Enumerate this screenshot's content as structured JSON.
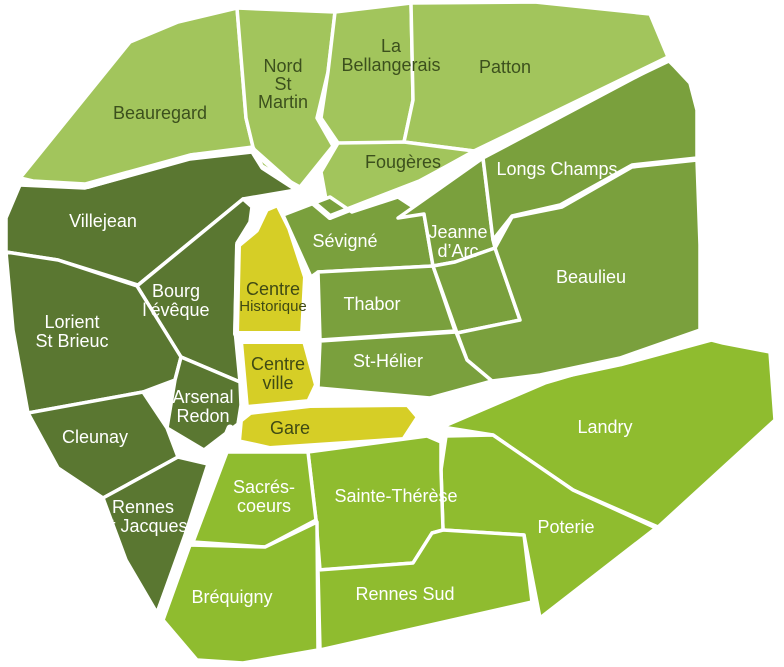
{
  "map": {
    "name": "rennes-districts-map",
    "width": 784,
    "height": 667,
    "background": "#ffffff",
    "stroke_color": "#ffffff",
    "group_fills": {
      "light": "#a2c55c",
      "medium": "#7aa03d",
      "dark": "#5a7731",
      "bright": "#8fbc2f",
      "yellow": "#d6ce26"
    },
    "label_colors": {
      "light": "#3c501d",
      "medium": "#ffffff",
      "dark": "#ffffff",
      "bright": "#ffffff",
      "yellow": "#3f4a14"
    },
    "default_font_size": 18,
    "default_line_height": 19,
    "regions": [
      {
        "id": "beauregard",
        "name": "Beauregard",
        "group": "light",
        "points": "20,178 130,42 178,22 237,8 246,118 253,147 190,155 85,184 33,181",
        "lines": [
          "Beauregard"
        ],
        "label_x": 160,
        "label_y": 119
      },
      {
        "id": "nord-st-martin",
        "name": "Nord St Martin",
        "group": "light",
        "points": "237,8 335,12 328,72 317,118 333,146 300,187 262,166 253,147 246,118",
        "lines": [
          "Nord",
          "St",
          "Martin"
        ],
        "label_x": 283,
        "label_y": 72,
        "line_height": 18
      },
      {
        "id": "la-bellangerais",
        "name": "La Bellangerais",
        "group": "light",
        "points": "335,12 411,3 413,100 404,142 398,148 338,143 321,118 328,72",
        "lines": [
          "La",
          "Bellangerais"
        ],
        "label_x": 391,
        "label_y": 52
      },
      {
        "id": "patton",
        "name": "Patton",
        "group": "light",
        "points": "411,3 535,2 650,14 668,57 474,151 404,142 413,100",
        "lines": [
          "Patton"
        ],
        "label_x": 505,
        "label_y": 73
      },
      {
        "id": "fougeres",
        "name": "Fougères",
        "group": "light",
        "points": "338,143 404,142 474,151 420,181 363,203 329,216 321,172",
        "lines": [
          "Fougères"
        ],
        "label_x": 403,
        "label_y": 168
      },
      {
        "id": "villejean",
        "name": "Villejean",
        "group": "dark",
        "points": "20,185 85,188 190,159 252,152 262,168 296,190 243,199 138,285 58,260 6,252 6,218",
        "lines": [
          "Villejean"
        ],
        "label_x": 103,
        "label_y": 227
      },
      {
        "id": "bourg-leveque",
        "name": "Bourg l’évêque",
        "group": "dark",
        "points": "243,199 252,207 250,222 237,243 235,330 240,382 181,357 137,286",
        "lines": [
          "Bourg",
          "l’évêque"
        ],
        "label_x": 176,
        "label_y": 297
      },
      {
        "id": "lorient-st-brieuc",
        "name": "Lorient St Brieuc",
        "group": "dark",
        "points": "6,252 58,260 137,286 181,357 175,380 143,392 28,413 13,330",
        "lines": [
          "Lorient",
          "St Brieuc"
        ],
        "label_x": 72,
        "label_y": 328
      },
      {
        "id": "arsenal-redon",
        "name": "Arsenal Redon",
        "group": "dark",
        "points": "181,357 240,382 241,405 238,424 204,450 167,428 175,380",
        "lines": [
          "Arsenal",
          "Redon"
        ],
        "label_x": 203,
        "label_y": 403
      },
      {
        "id": "cleunay",
        "name": "Cleunay",
        "group": "dark",
        "points": "28,413 143,392 167,428 178,457 103,498 58,468",
        "lines": [
          "Cleunay"
        ],
        "label_x": 95,
        "label_y": 443
      },
      {
        "id": "rennes-st-jacques",
        "name": "Rennes St Jacques",
        "group": "dark",
        "points": "103,498 178,457 208,464 185,535 157,613 126,560",
        "lines": [
          "Rennes",
          "St Jacques"
        ],
        "label_x": 143,
        "label_y": 513
      },
      {
        "id": "centre-historique",
        "name": "Centre Historique",
        "group": "yellow",
        "points": "256,230 266,209 278,204 290,228 306,277 303,334 236,334 238,245",
        "lines": [
          "Centre",
          "Historique"
        ],
        "label_x": 273,
        "label_y": 295,
        "sizes": [
          18,
          15
        ],
        "line_height": 16
      },
      {
        "id": "centre-ville",
        "name": "Centre ville",
        "group": "yellow",
        "points": "240,341 305,341 317,385 309,402 246,408",
        "lines": [
          "Centre",
          "ville"
        ],
        "label_x": 278,
        "label_y": 370
      },
      {
        "id": "gare",
        "name": "Gare",
        "group": "yellow",
        "points": "238,442 240,420 250,412 310,405 408,404 419,417 404,440 270,449",
        "lines": [
          "Gare"
        ],
        "label_x": 290,
        "label_y": 434
      },
      {
        "id": "sevigne",
        "name": "Sévigné",
        "group": "medium",
        "points": "283,215 330,197 352,212 398,197 424,214 433,266 318,272 311,277",
        "lines": [
          "Sévigné"
        ],
        "label_x": 345,
        "label_y": 247
      },
      {
        "id": "thabor",
        "name": "Thabor",
        "group": "medium",
        "points": "318,272 433,266 455,331 320,340",
        "lines": [
          "Thabor"
        ],
        "label_x": 372,
        "label_y": 310
      },
      {
        "id": "jeanne-darc",
        "name": "Jeanne d’Arc",
        "group": "medium",
        "points": "398,218 483,158 493,240 495,248 455,262 433,266 424,214",
        "lines": [
          "Jeanne",
          "d’Arc"
        ],
        "label_x": 458,
        "label_y": 238
      },
      {
        "id": "east-wedge",
        "name": "",
        "group": "medium",
        "points": "433,266 455,262 495,248 520,320 457,333",
        "lines": [],
        "label_x": 0,
        "label_y": 0
      },
      {
        "id": "longs-champs",
        "name": "Longs Champs",
        "group": "medium",
        "points": "483,158 668,60 675,67 690,83 697,110 697,158 632,165 560,205 512,216 493,240",
        "lines": [
          "Longs Champs"
        ],
        "label_x": 557,
        "label_y": 175
      },
      {
        "id": "beaulieu",
        "name": "Beaulieu",
        "group": "medium",
        "points": "495,248 512,217 562,207 632,167 697,160 700,245 700,330 620,358 540,375 492,381 467,360 457,333 520,320",
        "lines": [
          "Beaulieu"
        ],
        "label_x": 591,
        "label_y": 283
      },
      {
        "id": "st-helier",
        "name": "St-Hélier",
        "group": "medium",
        "points": "320,341 456,332 467,360 492,381 430,398 318,388",
        "lines": [
          "St-Hélier"
        ],
        "label_x": 388,
        "label_y": 367
      },
      {
        "id": "landry",
        "name": "Landry",
        "group": "bright",
        "points": "442,427 545,383 700,337 723,343 770,352 775,420 658,527 573,490 493,435",
        "lines": [
          "Landry"
        ],
        "label_x": 605,
        "label_y": 433
      },
      {
        "id": "poterie",
        "name": "Poterie",
        "group": "bright",
        "points": "446,436 493,435 573,490 656,528 540,618 524,535 443,530 441,470",
        "lines": [
          "Poterie"
        ],
        "label_x": 566,
        "label_y": 533
      },
      {
        "id": "sainte-therese",
        "name": "Sainte-Thérèse",
        "group": "bright",
        "points": "308,452 427,436 441,442 441,470 443,530 432,533 413,563 320,570 316,520",
        "lines": [
          "Sainte-Thérèse"
        ],
        "label_x": 396,
        "label_y": 502
      },
      {
        "id": "sacres-coeurs",
        "name": "Sacrés-coeurs",
        "group": "bright",
        "points": "227,452 308,452 316,520 265,547 193,542",
        "lines": [
          "Sacrés-",
          "coeurs"
        ],
        "label_x": 264,
        "label_y": 493
      },
      {
        "id": "rennes-sud",
        "name": "Rennes Sud",
        "group": "bright",
        "points": "318,570 413,563 432,533 443,530 524,535 532,602 320,650",
        "lines": [
          "Rennes Sud"
        ],
        "label_x": 405,
        "label_y": 600
      },
      {
        "id": "brequigny",
        "name": "Bréquigny",
        "group": "bright",
        "points": "190,545 265,547 317,522 318,650 243,663 197,660 163,620",
        "lines": [
          "Bréquigny"
        ],
        "label_x": 232,
        "label_y": 603
      }
    ],
    "thick_borders": [
      {
        "id": "border-beauregard-villejean",
        "points": "18,182 88,186 192,156 253,150",
        "width": 6
      },
      {
        "id": "border-nordstmartin-sevigne",
        "points": "253,150 298,190 330,217",
        "width": 6
      },
      {
        "id": "border-patton-longschamps",
        "points": "668,60 474,153 420,182 363,204 330,217",
        "width": 6
      },
      {
        "id": "border-beaulieu-landry",
        "points": "723,334 620,362 540,379 490,389 426,424",
        "width": 9
      },
      {
        "id": "border-stjacques-brequigny",
        "points": "230,428 216,462 188,535 158,615",
        "width": 7
      }
    ]
  }
}
